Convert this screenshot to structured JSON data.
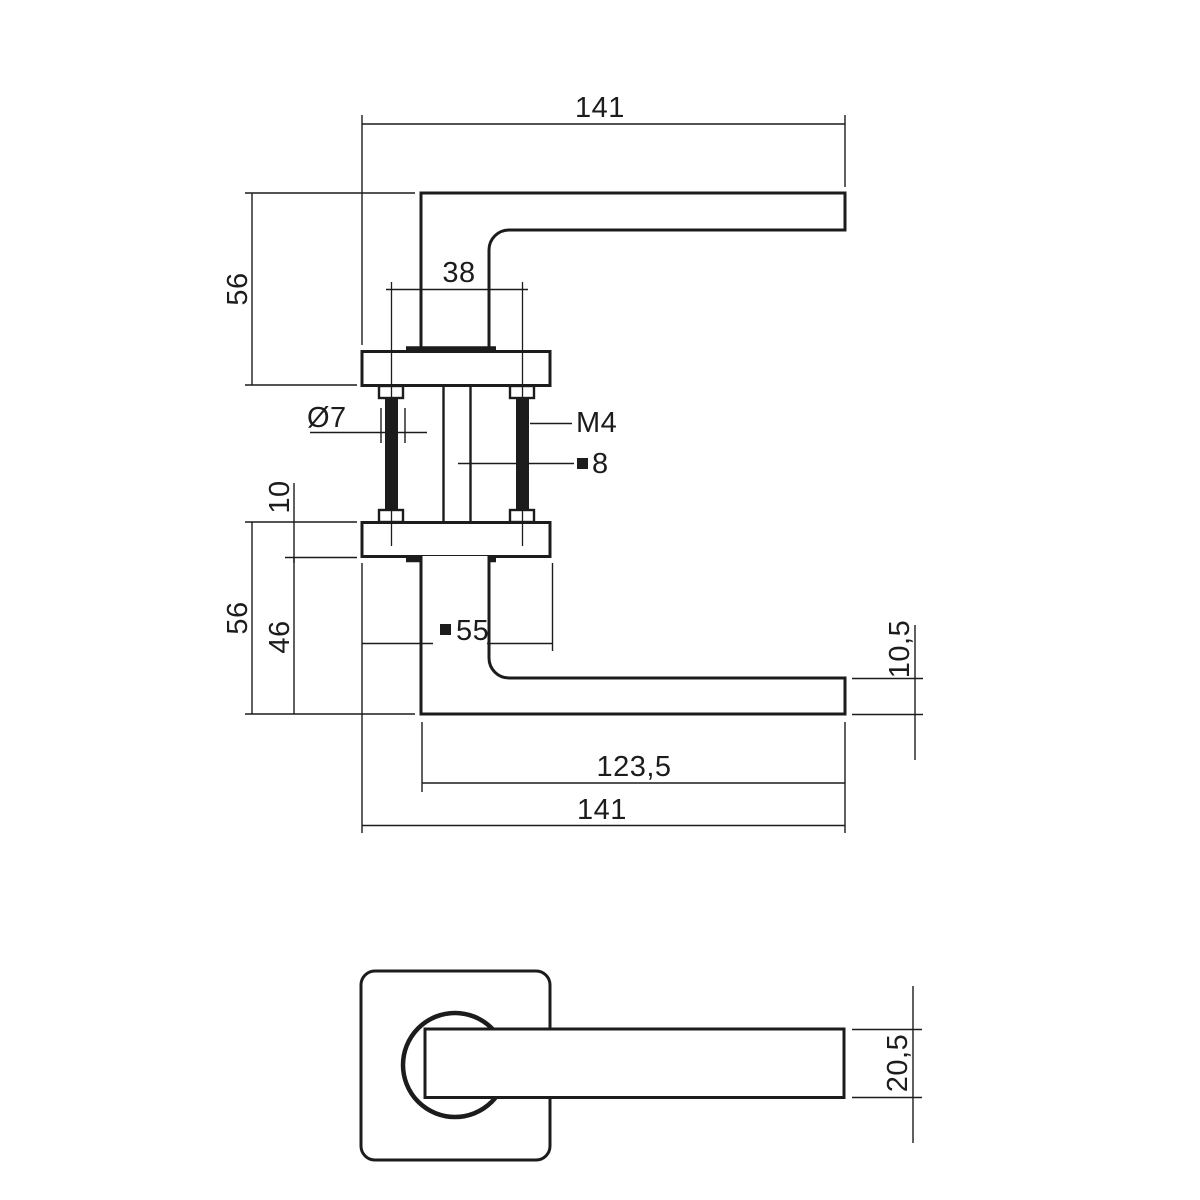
{
  "drawing": {
    "colors": {
      "background": "#ffffff",
      "ink": "#1c1c1c"
    },
    "symbols": {
      "square": "■",
      "diameter": "Ø"
    },
    "side_view": {
      "dims": {
        "top_overall": "141",
        "top_height": "56",
        "bolt_spacing": "38",
        "bolt_diameter": "Ø7",
        "bolt_thread": "M4",
        "spindle_size": "8",
        "rose_thickness": "10",
        "bottom_height": "56",
        "grip_height": "46",
        "rose_size": "55",
        "lever_thickness": "10,5",
        "grip_length": "123,5",
        "bottom_overall": "141"
      }
    },
    "front_view": {
      "dims": {
        "lever_profile": "20,5"
      }
    }
  }
}
